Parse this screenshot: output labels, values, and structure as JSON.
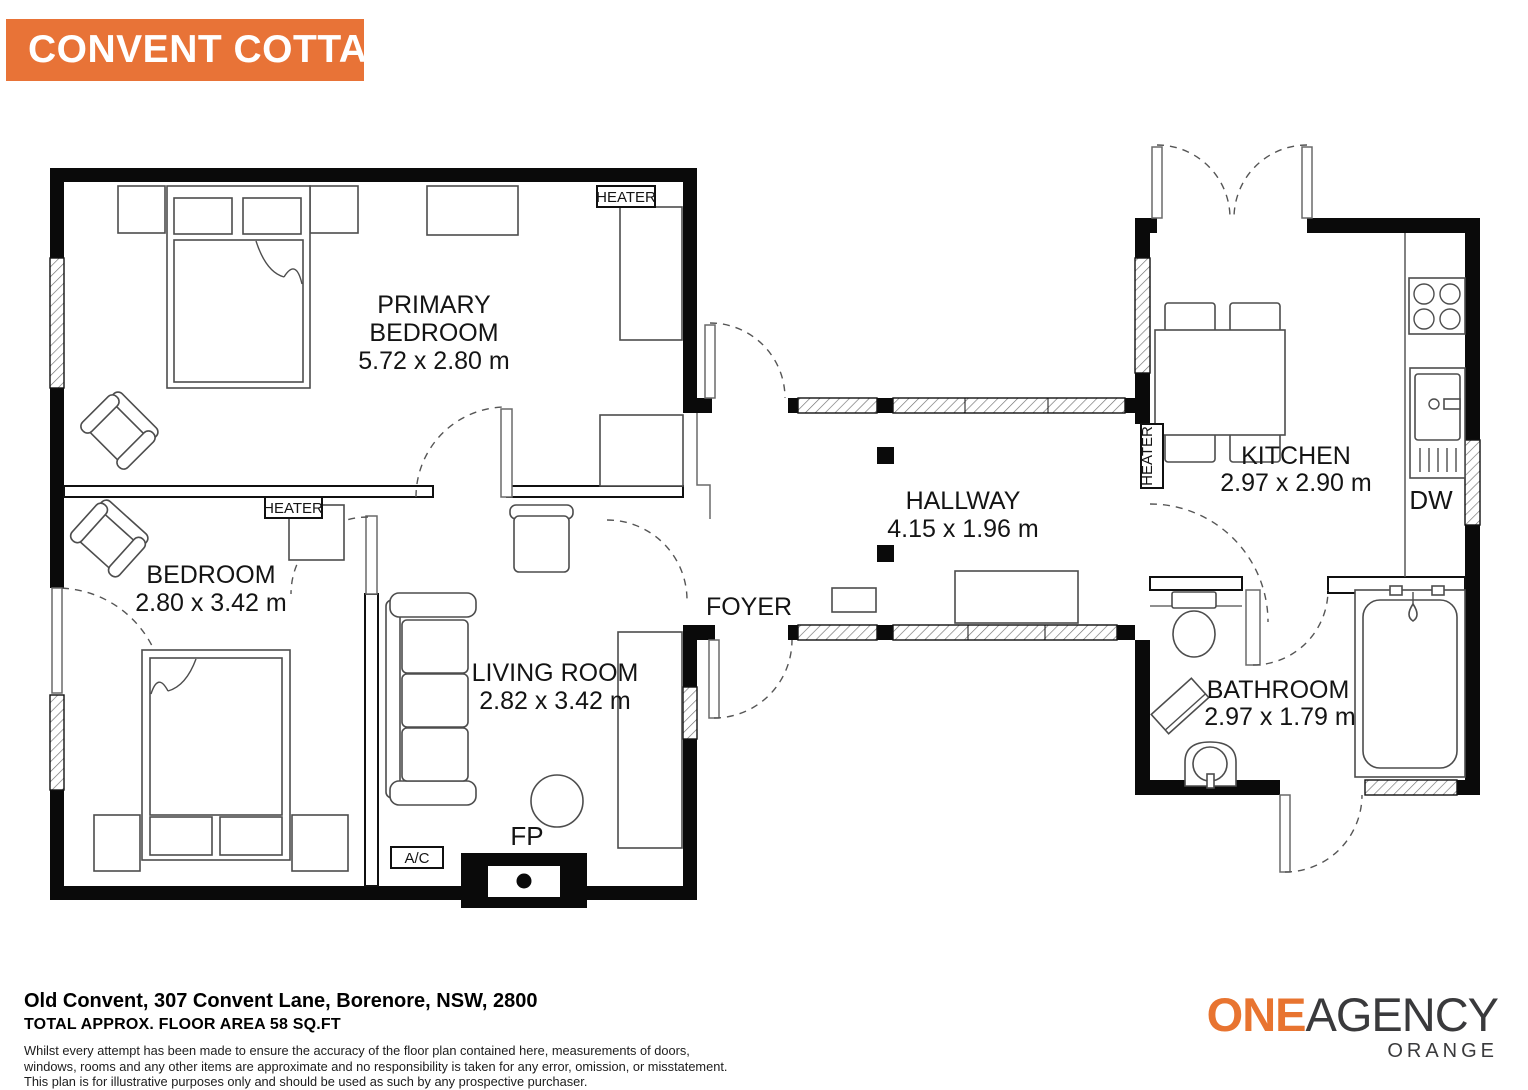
{
  "banner": {
    "title": "CONVENT COTTAGE",
    "bg_color": "#E87337",
    "text_color": "#FFFFFF"
  },
  "plan": {
    "rooms": [
      {
        "id": "primary-bedroom",
        "line1": "PRIMARY",
        "line2": "BEDROOM",
        "dims": "5.72 x 2.80 m"
      },
      {
        "id": "bedroom",
        "line1": "BEDROOM",
        "dims": "2.80 x 3.42 m"
      },
      {
        "id": "living-room",
        "line1": "LIVING ROOM",
        "dims": "2.82 x 3.42 m"
      },
      {
        "id": "foyer",
        "line1": "FOYER"
      },
      {
        "id": "hallway",
        "line1": "HALLWAY",
        "dims": "4.15 x 1.96 m"
      },
      {
        "id": "kitchen",
        "line1": "KITCHEN",
        "dims": "2.97 x 2.90 m"
      },
      {
        "id": "bathroom",
        "line1": "BATHROOM",
        "dims": "2.97 x 1.79 m"
      }
    ],
    "fixtures": {
      "heater_primary": "HEATER",
      "heater_bedroom": "HEATER",
      "heater_kitchen": "HEATER",
      "ac": "A/C",
      "fireplace": "FP",
      "dishwasher": "DW"
    }
  },
  "footer": {
    "address": "Old Convent, 307 Convent Lane, Borenore, NSW, 2800",
    "area": "TOTAL APPROX. FLOOR AREA 58 SQ.FT",
    "disclaimer_lines": [
      "Whilst every attempt has been made to ensure the accuracy of the floor plan contained here, measurements of doors,",
      "windows, rooms and any other items are approximate and no responsibility is taken for any error, omission, or misstatement.",
      "This plan is for illustrative purposes only and should be used as such by any prospective purchaser."
    ]
  },
  "logo": {
    "part1": "ONE",
    "part2": "AGENCY",
    "subtitle": "ORANGE",
    "orange_color": "#E87430",
    "dark_color": "#3A3A3C"
  }
}
